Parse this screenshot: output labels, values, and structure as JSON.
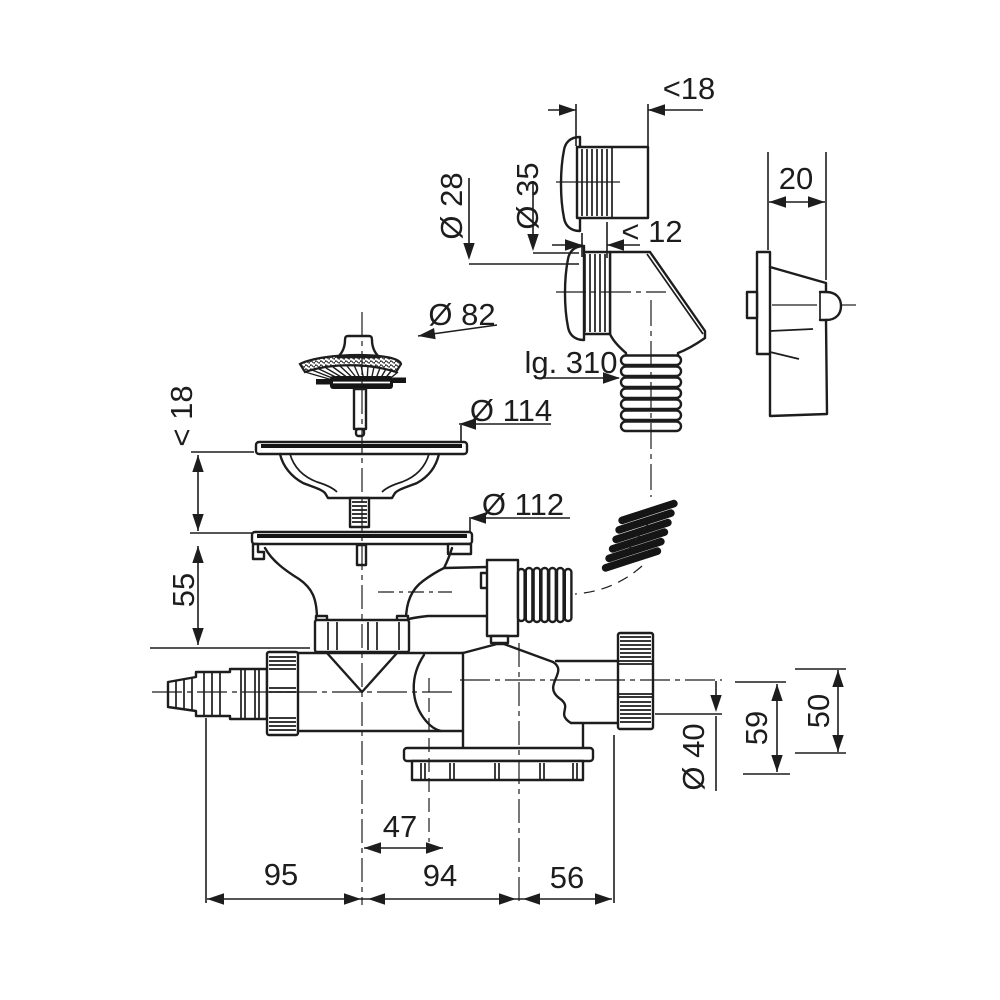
{
  "drawing": {
    "type": "technical-drawing",
    "subject": "sink-strainer-waste-and-space-saving-siphon-with-appliance-connection",
    "colors": {
      "line": "#1d1d1d",
      "background": "#ffffff",
      "seal": "#151515"
    },
    "dimensions": {
      "top_sleeve_length": "<18",
      "overflow_hose_diameter": "Ø 28",
      "overflow_nut_diameter": "Ø 35",
      "elbow_thread_length": "< 12",
      "bracket_width": "20",
      "strainer_diameter": "Ø 82",
      "hose_length": "lg. 310",
      "clamp_thickness": "< 18",
      "upper_flange_diameter": "Ø 114",
      "lower_flange_diameter": "Ø 112",
      "inlet_height": "55",
      "outlet_diameter": "Ø 40",
      "outlet_height": "59",
      "outlet_drop": "50",
      "inlet_offset": "47",
      "span_left": "95",
      "span_middle": "94",
      "span_right": "56"
    }
  }
}
